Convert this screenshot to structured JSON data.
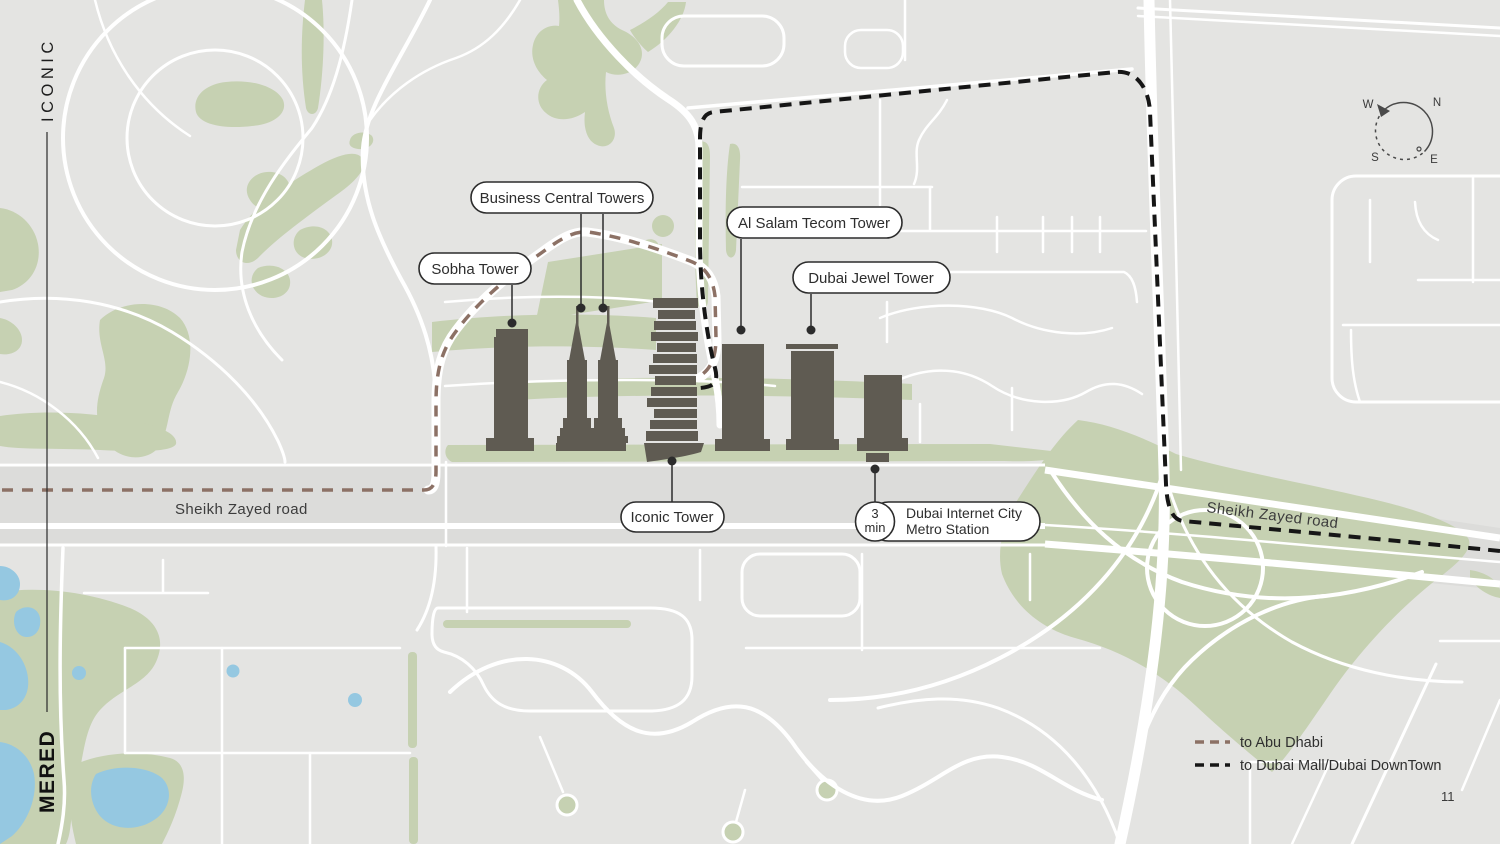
{
  "brand": {
    "name_top": "ICONIC",
    "name_bottom": "MERED"
  },
  "map": {
    "pills": {
      "business_central": "Business Central Towers",
      "sobha": "Sobha Tower",
      "al_salam": "Al Salam Tecom Tower",
      "jewel": "Dubai Jewel Tower",
      "iconic": "Iconic Tower"
    },
    "metro": {
      "time": "3",
      "unit": "min",
      "line1": "Dubai Internet City",
      "line2": "Metro Station"
    },
    "road_labels": {
      "left": "Sheikh Zayed road",
      "right": "Sheikh Zayed road"
    }
  },
  "compass": {
    "n": "N",
    "e": "E",
    "s": "S",
    "w": "W"
  },
  "legend": {
    "items": [
      {
        "label": "to Abu Dhabi",
        "color": "#8c7165"
      },
      {
        "label": "to Dubai Mall/Dubai DownTown",
        "color": "#161616"
      }
    ]
  },
  "page_number": "11",
  "colors": {
    "background": "#e4e4e2",
    "road": "#ffffff",
    "highway_band": "#dcdcda",
    "green": "#c6d1b2",
    "water": "#95c8e1",
    "building": "#5f5b52",
    "route_abu_dhabi": "#8c7165",
    "route_dubai_mall": "#161616",
    "label_ink": "#2d2d2d"
  }
}
